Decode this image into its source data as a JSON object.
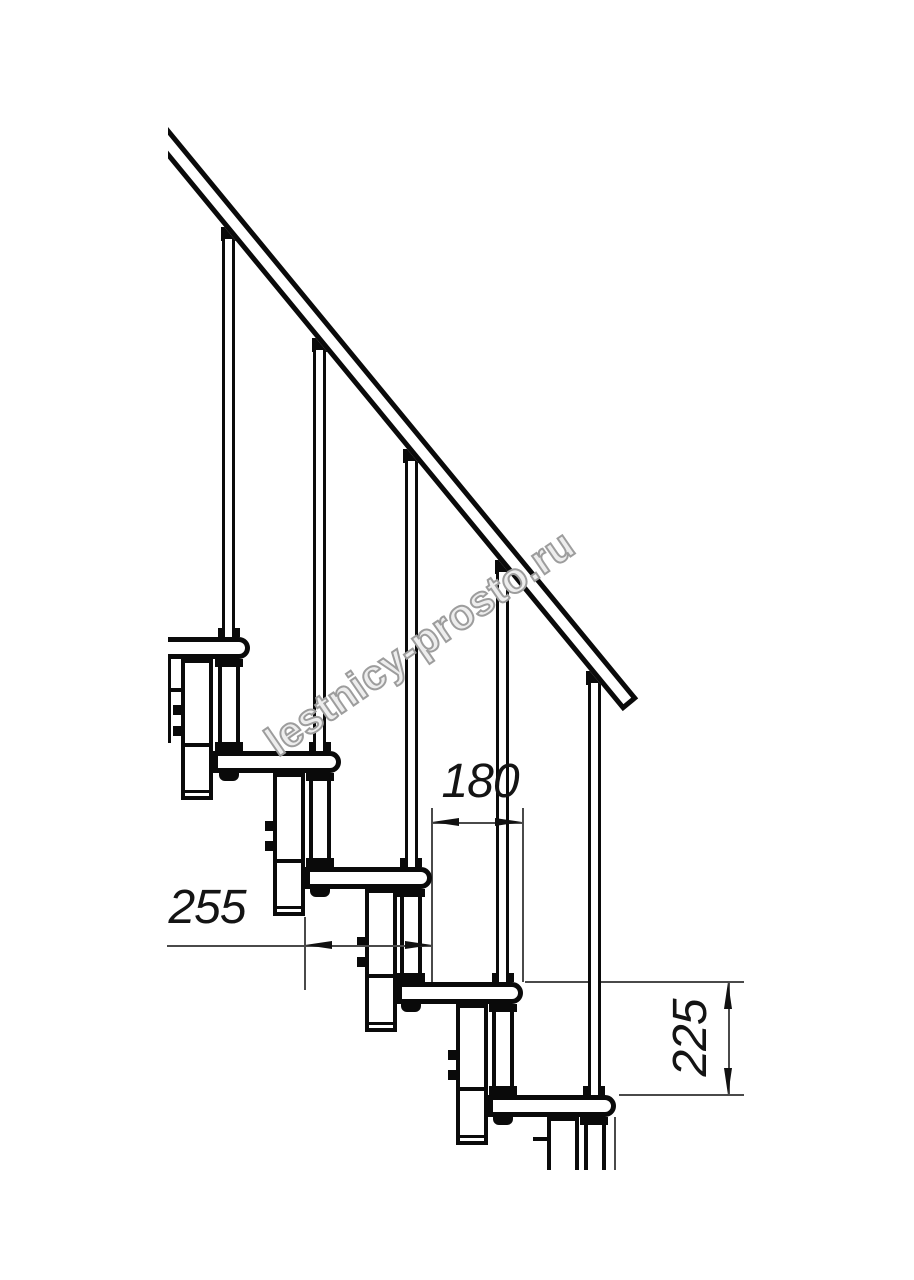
{
  "page": {
    "type": "technical drawing",
    "subject": "modular staircase side elevation",
    "background": "#ffffff"
  },
  "watermark": {
    "text": "lestnicy-prosto.ru"
  },
  "dimensions": {
    "run": {
      "value": "180",
      "orientation": "horizontal",
      "measures": "horizontal offset between step noses"
    },
    "tread_depth": {
      "value": "255",
      "orientation": "horizontal",
      "measures": "tread depth"
    },
    "rise": {
      "value": "225",
      "orientation": "vertical",
      "measures": "step rise between tread tops"
    }
  },
  "structure": {
    "treads_visible": 5,
    "balusters_visible": 5,
    "support_columns_visible": 5,
    "handrail": "diagonal from upper-left down to mid-right"
  },
  "colors": {
    "line": "#0a0a0a",
    "dim_line": "#4a4a4a",
    "arrow": "#111111",
    "watermark_fill": "#ededed",
    "watermark_stroke": "#9d9d9d"
  }
}
